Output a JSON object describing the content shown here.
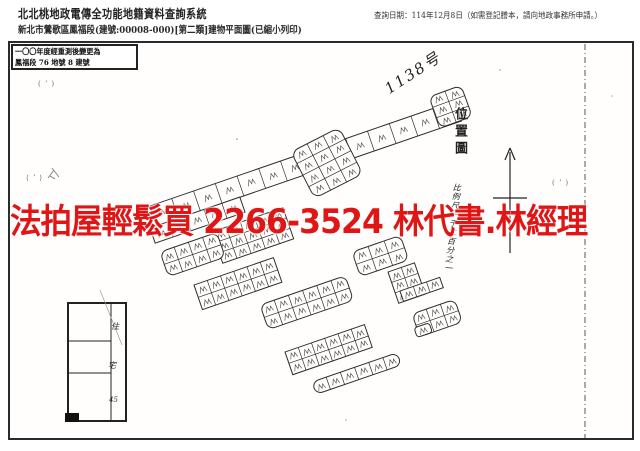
{
  "header": {
    "title": "北北桃地政電傳全功能地籍資料查詢系統",
    "subtitle": "新北市鶯歌區鳳福段(建號:00008-000)[第二類]建物平面圖(已縮小列印)",
    "query_date": "查詢日期：114年12月8日（如需登記謄本，請向地政事務所申請。）"
  },
  "watermark": {
    "ad_text": "法拍屋輕鬆買 2266-3524 林代書.林經理",
    "ad_color": "#e01515"
  },
  "map": {
    "note_line1": "一〇〇年度經重測後變更為",
    "note_line2": "鳳福段 76 地號 8 建號",
    "handwritten_parcel_no": "1138号",
    "location_map_label": "位置圖",
    "scale_label": "比例尺一千二百分之一",
    "floorplan_labels": [
      "住",
      "宅",
      "45"
    ],
    "stray_marks": [
      "( ʼ )",
      "⟨ ʼ ⟩",
      "( ʼ )"
    ]
  }
}
